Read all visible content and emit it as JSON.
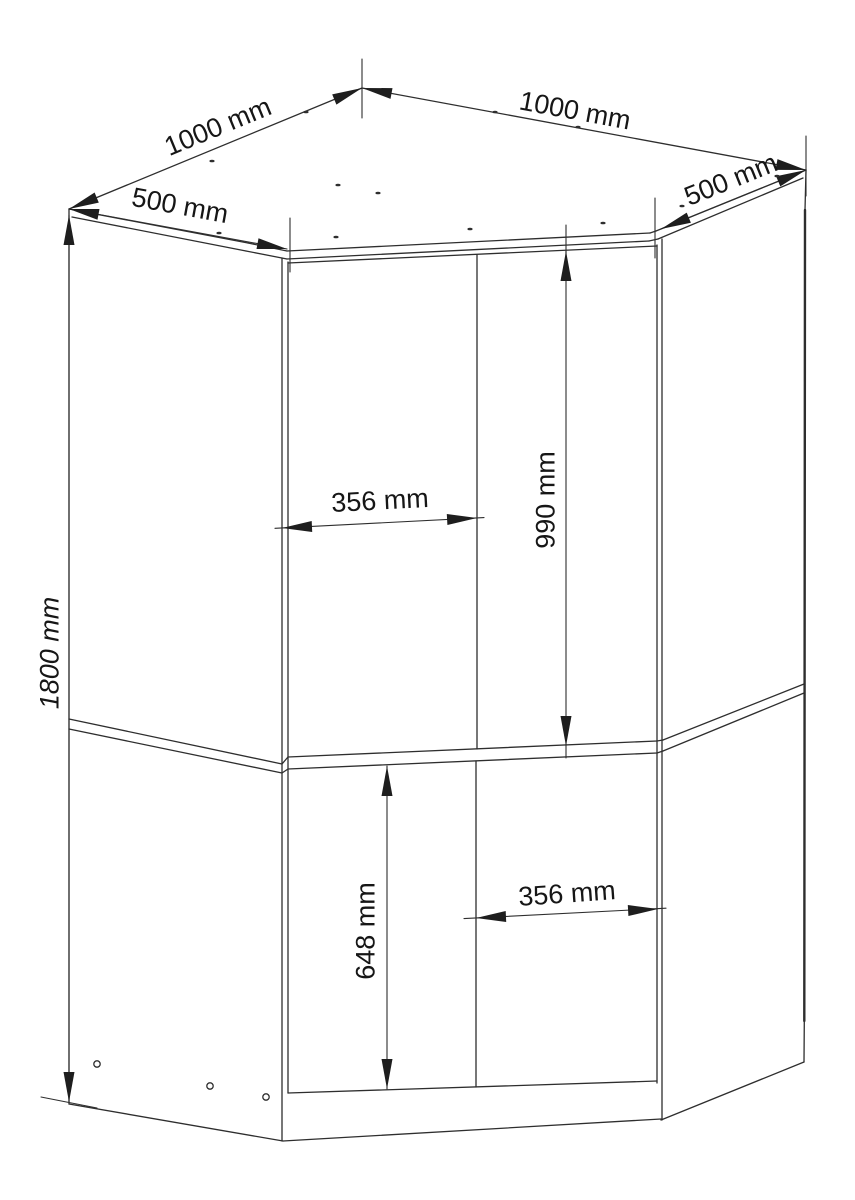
{
  "diagram": {
    "unit": "mm",
    "colors": {
      "line": "#2e2e2e",
      "arrow": "#1e1e1e",
      "text": "#161616",
      "background": "#ffffff"
    },
    "dimensions": {
      "top_left_edge": {
        "label": "1000 mm",
        "value": 1000
      },
      "top_right_edge": {
        "label": "1000 mm",
        "value": 1000
      },
      "left_side_depth": {
        "label": "500 mm",
        "value": 500
      },
      "right_side_depth": {
        "label": "500 mm",
        "value": 500
      },
      "overall_height": {
        "label": "1800 mm",
        "value": 1800
      },
      "upper_door_height": {
        "label": "990 mm",
        "value": 990
      },
      "upper_door_width": {
        "label": "356 mm",
        "value": 356
      },
      "lower_door_height": {
        "label": "648 mm",
        "value": 648
      },
      "lower_door_width": {
        "label": "356 mm",
        "value": 356
      }
    }
  }
}
